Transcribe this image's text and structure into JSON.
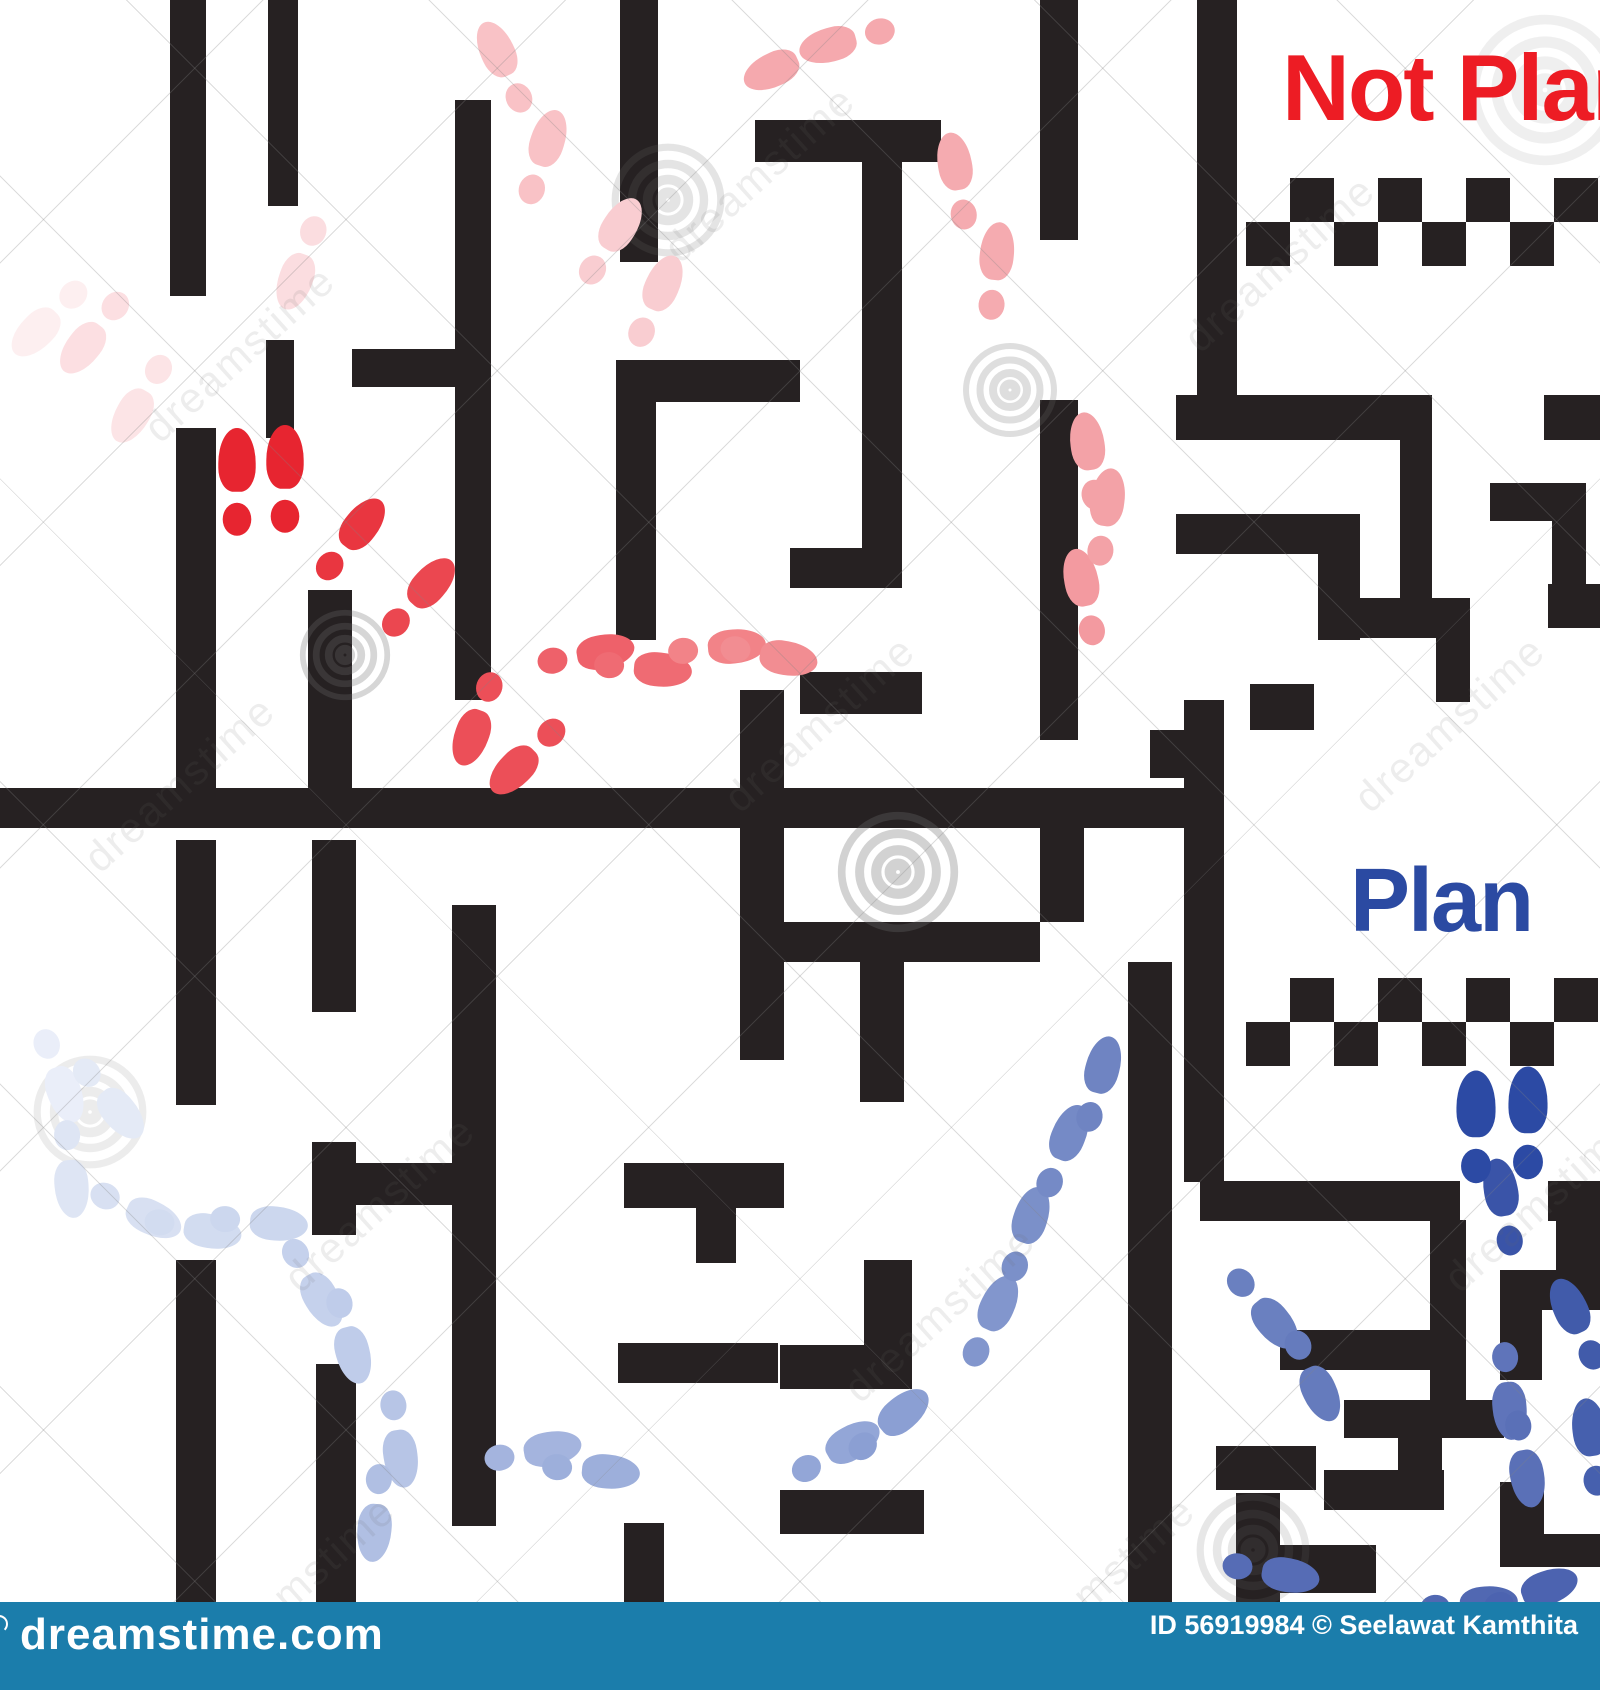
{
  "labels": {
    "not_plan": "Not Plan",
    "plan": "Plan"
  },
  "colors": {
    "not_plan_text": "#ed1c24",
    "plan_text": "#2b4aa2",
    "wall": "#262122",
    "background": "#ffffff",
    "bottom_bar": "#1b7dab",
    "bar_text": "#ffffff",
    "red_trail_strong": "#e72530",
    "red_trail_faint": "#fdeff0",
    "blue_trail_strong": "#2c4aa4",
    "blue_trail_faint": "#eaeef9"
  },
  "watermark": {
    "logo_text": "dreamstime.com",
    "credit_text": "ID 56919984 © Seelawat Kamthita",
    "tile_text": "dreamstime",
    "tiles": [
      [
        120,
        330
      ],
      [
        640,
        150
      ],
      [
        1160,
        240
      ],
      [
        60,
        760
      ],
      [
        700,
        700
      ],
      [
        1330,
        700
      ],
      [
        260,
        1180
      ],
      [
        820,
        1290
      ],
      [
        1420,
        1180
      ],
      [
        180,
        1560
      ],
      [
        980,
        1560
      ]
    ],
    "spirals": [
      [
        668,
        200,
        60,
        0.18
      ],
      [
        898,
        872,
        64,
        0.3
      ],
      [
        345,
        655,
        48,
        0.28
      ],
      [
        1545,
        90,
        80,
        0.1
      ],
      [
        90,
        1112,
        60,
        0.12
      ],
      [
        1253,
        1550,
        60,
        0.16
      ],
      [
        1010,
        390,
        50,
        0.22
      ]
    ]
  },
  "maze": {
    "divider": [
      0,
      788,
      1224,
      40
    ],
    "walls_top": [
      [
        170,
        0,
        36,
        296
      ],
      [
        268,
        0,
        30,
        206
      ],
      [
        266,
        340,
        28,
        98
      ],
      [
        455,
        100,
        36,
        600
      ],
      [
        620,
        0,
        38,
        262
      ],
      [
        352,
        349,
        136,
        38
      ],
      [
        616,
        360,
        184,
        42
      ],
      [
        616,
        402,
        40,
        238
      ],
      [
        176,
        428,
        40,
        360
      ],
      [
        308,
        590,
        44,
        198
      ],
      [
        740,
        690,
        44,
        370
      ],
      [
        755,
        120,
        186,
        42
      ],
      [
        862,
        162,
        40,
        386
      ],
      [
        790,
        548,
        112,
        40
      ],
      [
        800,
        672,
        122,
        42
      ],
      [
        1040,
        0,
        38,
        240
      ],
      [
        1040,
        400,
        38,
        340
      ],
      [
        1197,
        0,
        40,
        400
      ],
      [
        1176,
        395,
        256,
        45
      ],
      [
        1544,
        395,
        56,
        45
      ],
      [
        1400,
        440,
        32,
        160
      ],
      [
        1176,
        514,
        184,
        40
      ],
      [
        1318,
        554,
        42,
        86
      ],
      [
        1360,
        598,
        110,
        40
      ],
      [
        1436,
        638,
        34,
        64
      ],
      [
        1490,
        483,
        96,
        38
      ],
      [
        1552,
        483,
        34,
        108
      ],
      [
        1548,
        584,
        52,
        44
      ],
      [
        1250,
        684,
        64,
        46
      ],
      [
        1150,
        730,
        50,
        48
      ],
      [
        1184,
        700,
        40,
        482
      ]
    ],
    "walls_bottom": [
      [
        176,
        840,
        40,
        265
      ],
      [
        176,
        1260,
        40,
        344
      ],
      [
        312,
        840,
        44,
        172
      ],
      [
        312,
        1142,
        44,
        93
      ],
      [
        356,
        1163,
        96,
        42
      ],
      [
        316,
        1364,
        40,
        240
      ],
      [
        452,
        905,
        44,
        621
      ],
      [
        618,
        1343,
        160,
        40
      ],
      [
        624,
        1163,
        160,
        45
      ],
      [
        696,
        1208,
        40,
        55
      ],
      [
        624,
        1523,
        40,
        81
      ],
      [
        780,
        1490,
        144,
        44
      ],
      [
        780,
        922,
        260,
        40
      ],
      [
        860,
        962,
        44,
        140
      ],
      [
        1040,
        818,
        44,
        104
      ],
      [
        1128,
        962,
        44,
        642
      ],
      [
        864,
        1260,
        48,
        90
      ],
      [
        780,
        1345,
        132,
        44
      ],
      [
        1200,
        1181,
        260,
        40
      ],
      [
        1548,
        1181,
        52,
        40
      ],
      [
        1430,
        1220,
        36,
        216
      ],
      [
        1280,
        1330,
        186,
        40
      ],
      [
        1344,
        1400,
        160,
        38
      ],
      [
        1398,
        1438,
        44,
        70
      ],
      [
        1324,
        1470,
        120,
        40
      ],
      [
        1216,
        1446,
        100,
        44
      ],
      [
        1236,
        1493,
        44,
        111
      ],
      [
        1280,
        1545,
        96,
        48
      ],
      [
        1500,
        1482,
        44,
        85
      ],
      [
        1544,
        1534,
        56,
        33
      ],
      [
        1500,
        1270,
        100,
        40
      ],
      [
        1500,
        1310,
        42,
        70
      ],
      [
        1556,
        1221,
        44,
        70
      ]
    ]
  },
  "checkers": {
    "cell": 44,
    "cols": 8,
    "strips": [
      {
        "x": 1246,
        "y": 178
      },
      {
        "x": 1246,
        "y": 978
      }
    ]
  },
  "footprints": {
    "red": [
      {
        "x": 237,
        "y": 483,
        "r": 0,
        "c": "#e72530",
        "s": 1.1
      },
      {
        "x": 285,
        "y": 480,
        "r": 0,
        "c": "#e72530",
        "s": 1.1
      },
      {
        "x": 350,
        "y": 540,
        "r": 38,
        "c": "#e93640"
      },
      {
        "x": 418,
        "y": 598,
        "r": 42,
        "c": "#eb4750"
      },
      {
        "x": 478,
        "y": 718,
        "r": 200,
        "c": "#ec4f58"
      },
      {
        "x": 528,
        "y": 756,
        "r": 225,
        "c": "#ec4f58"
      },
      {
        "x": 585,
        "y": 655,
        "r": 80,
        "c": "#ee616a"
      },
      {
        "x": 642,
        "y": 668,
        "r": 95,
        "c": "#ef6b73"
      },
      {
        "x": 716,
        "y": 648,
        "r": 85,
        "c": "#f28388"
      },
      {
        "x": 768,
        "y": 655,
        "r": 100,
        "c": "#f28d92"
      },
      {
        "x": 1085,
        "y": 598,
        "r": -12,
        "c": "#f39aa0"
      },
      {
        "x": 1105,
        "y": 518,
        "r": 8,
        "c": "#f3a2a7"
      },
      {
        "x": 1090,
        "y": 462,
        "r": -8,
        "c": "#f3a2a7"
      },
      {
        "x": 995,
        "y": 272,
        "r": 6,
        "c": "#f5abb0"
      },
      {
        "x": 958,
        "y": 182,
        "r": -10,
        "c": "#f5abb0"
      },
      {
        "x": 790,
        "y": 62,
        "r": -115,
        "c": "#f5a9ae"
      },
      {
        "x": 848,
        "y": 40,
        "r": -105,
        "c": "#f5a9ae"
      },
      {
        "x": 505,
        "y": 68,
        "r": -25,
        "c": "#f9c2c6"
      },
      {
        "x": 542,
        "y": 158,
        "r": 18,
        "c": "#f9c2c6"
      },
      {
        "x": 610,
        "y": 242,
        "r": 32,
        "c": "#f9cdd1"
      },
      {
        "x": 655,
        "y": 302,
        "r": 24,
        "c": "#f9cdd1"
      },
      {
        "x": 302,
        "y": 262,
        "r": -160,
        "c": "#fbdde0"
      },
      {
        "x": 95,
        "y": 332,
        "r": -142,
        "c": "#fcdfe2"
      },
      {
        "x": 142,
        "y": 398,
        "r": -150,
        "c": "#fce4e6"
      },
      {
        "x": 50,
        "y": 318,
        "r": -135,
        "c": "#fdeff0"
      }
    ],
    "blue": [
      {
        "x": 58,
        "y": 1075,
        "r": 160,
        "c": "#eaeef9"
      },
      {
        "x": 108,
        "y": 1098,
        "r": 140,
        "c": "#e4eaf6"
      },
      {
        "x": 70,
        "y": 1168,
        "r": 175,
        "c": "#dee5f4"
      },
      {
        "x": 135,
        "y": 1210,
        "r": 115,
        "c": "#d8e0f2"
      },
      {
        "x": 192,
        "y": 1228,
        "r": 100,
        "c": "#d2dcf0"
      },
      {
        "x": 258,
        "y": 1222,
        "r": 95,
        "c": "#ccd7ee"
      },
      {
        "x": 312,
        "y": 1282,
        "r": 150,
        "c": "#c5d1ec"
      },
      {
        "x": 348,
        "y": 1335,
        "r": 165,
        "c": "#bfccea"
      },
      {
        "x": 398,
        "y": 1438,
        "r": 172,
        "c": "#b7c5e6"
      },
      {
        "x": 376,
        "y": 1512,
        "r": 185,
        "c": "#b0bfe3"
      },
      {
        "x": 532,
        "y": 1452,
        "r": 80,
        "c": "#a4b4de"
      },
      {
        "x": 590,
        "y": 1470,
        "r": 95,
        "c": "#9dafdb"
      },
      {
        "x": 835,
        "y": 1452,
        "r": 60,
        "c": "#93a6d7"
      },
      {
        "x": 888,
        "y": 1425,
        "r": 50,
        "c": "#8b9fd3"
      },
      {
        "x": 990,
        "y": 1322,
        "r": 25,
        "c": "#8296cd"
      },
      {
        "x": 1025,
        "y": 1235,
        "r": 18,
        "c": "#7b90c9"
      },
      {
        "x": 1062,
        "y": 1152,
        "r": 22,
        "c": "#758ac6"
      },
      {
        "x": 1098,
        "y": 1085,
        "r": 15,
        "c": "#6f84c2"
      },
      {
        "x": 1262,
        "y": 1308,
        "r": 140,
        "c": "#6a80c0"
      },
      {
        "x": 1312,
        "y": 1375,
        "r": 155,
        "c": "#657bbd"
      },
      {
        "x": 1508,
        "y": 1390,
        "r": 175,
        "c": "#5f74ba"
      },
      {
        "x": 1524,
        "y": 1458,
        "r": 170,
        "c": "#5a70b7"
      },
      {
        "x": 1270,
        "y": 1572,
        "r": 100,
        "c": "#566cb5"
      },
      {
        "x": 1468,
        "y": 1605,
        "r": 85,
        "c": "#5168b2"
      },
      {
        "x": 1530,
        "y": 1594,
        "r": 70,
        "c": "#4c63b0"
      },
      {
        "x": 1592,
        "y": 1448,
        "r": -8,
        "c": "#4660ae"
      },
      {
        "x": 1578,
        "y": 1325,
        "r": -25,
        "c": "#415baa"
      },
      {
        "x": 1504,
        "y": 1208,
        "r": -10,
        "c": "#3a54a8"
      },
      {
        "x": 1476,
        "y": 1128,
        "r": 0,
        "c": "#2c4aa4",
        "s": 1.15
      },
      {
        "x": 1528,
        "y": 1124,
        "r": 0,
        "c": "#2c4aa4",
        "s": 1.15
      }
    ]
  }
}
